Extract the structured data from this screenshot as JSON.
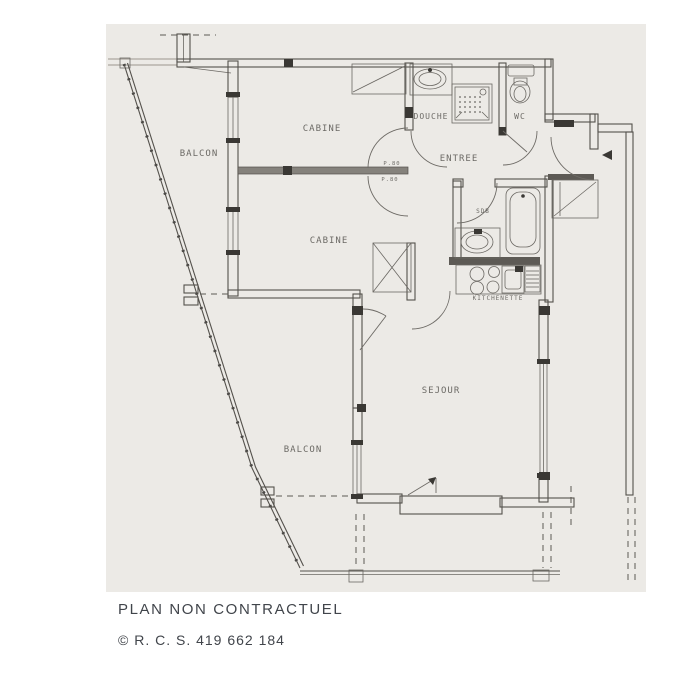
{
  "colors": {
    "page_background": "#ffffff",
    "scan_paper": "#eceae6",
    "ink": "#54514c"
  },
  "plan": {
    "labels": {
      "balcon_top": "BALCON",
      "cabine_top": "CABINE",
      "cabine_bottom": "CABINE",
      "entree": "ENTREE",
      "douche": "DOUCHE",
      "wc": "WC",
      "sdb": "SDB",
      "kitchenette": "KITCHENETTE",
      "sejour": "SEJOUR",
      "balcon_bottom": "BALCON",
      "door_p80_top": "P.80",
      "door_p80_bottom": "P.80"
    }
  },
  "footer": {
    "line1": "PLAN NON CONTRACTUEL",
    "line2": "© R. C. S. 419 662 184"
  }
}
